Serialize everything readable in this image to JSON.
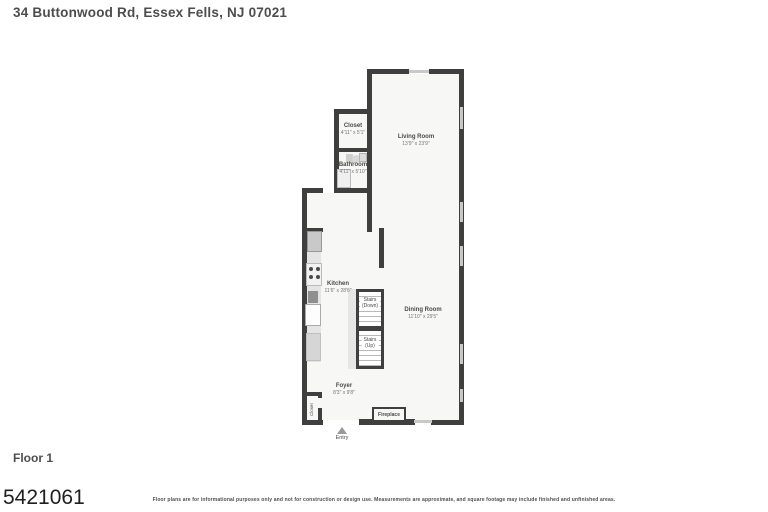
{
  "header": {
    "title": "34 Buttonwood Rd, Essex Fells, NJ 07021"
  },
  "footer": {
    "floor_label": "Floor 1",
    "listing_number": "5421061",
    "disclaimer": "Floor plans are for informational purposes only and not for construction or design use. Measurements are approximate, and square footage may include finished and unfinished areas."
  },
  "floorplan": {
    "rooms": {
      "closet_top": {
        "name": "Closet",
        "dims": "4'11\" x 5'1\""
      },
      "bathroom": {
        "name": "Bathroom",
        "dims": "4'11\" x 5'10\""
      },
      "living": {
        "name": "Living Room",
        "dims": "13'9\" x 23'9\""
      },
      "kitchen": {
        "name": "Kitchen",
        "dims": "11'6\" x 28'6\""
      },
      "dining": {
        "name": "Dining Room",
        "dims": "11'10\" x 29'5\""
      },
      "foyer": {
        "name": "Foyer",
        "dims": "8'3\" x 9'8\""
      },
      "stairs_down": {
        "line1": "Stairs",
        "line2": "(Down)"
      },
      "stairs_up": {
        "line1": "Stairs",
        "line2": "(Up)"
      },
      "closet_bottom": {
        "name": "Closet"
      },
      "fireplace": {
        "name": "Fireplace"
      },
      "entry": {
        "name": "Entry"
      }
    },
    "colors": {
      "wall": "#3f3f3f",
      "floor": "#f7f7f6",
      "window": "#c9c9c9",
      "fixture": "#d9d9d9",
      "label_text": "#4a4a4a"
    }
  }
}
